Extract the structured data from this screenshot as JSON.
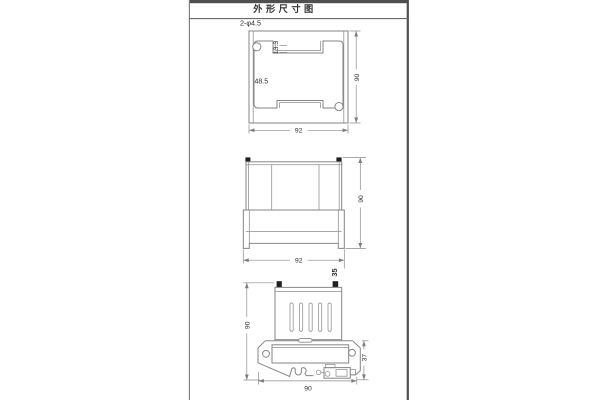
{
  "title": "外形尺寸图",
  "views": {
    "top": {
      "hole_label": "2-φ4.5",
      "width": "92",
      "height": "90",
      "slot_width": "48.5",
      "notch_depth": "13.3"
    },
    "front": {
      "width": "92",
      "height": "90",
      "depth": "35"
    },
    "side": {
      "height": "90",
      "clip_height": "37",
      "width": "90"
    }
  },
  "colors": {
    "drawing_line": "#868686",
    "frame_line": "#4f4f4f",
    "dimension_text": "#2e2e2e",
    "mount_tab_fill": "#1f1f1f",
    "background": "#ffffff"
  }
}
